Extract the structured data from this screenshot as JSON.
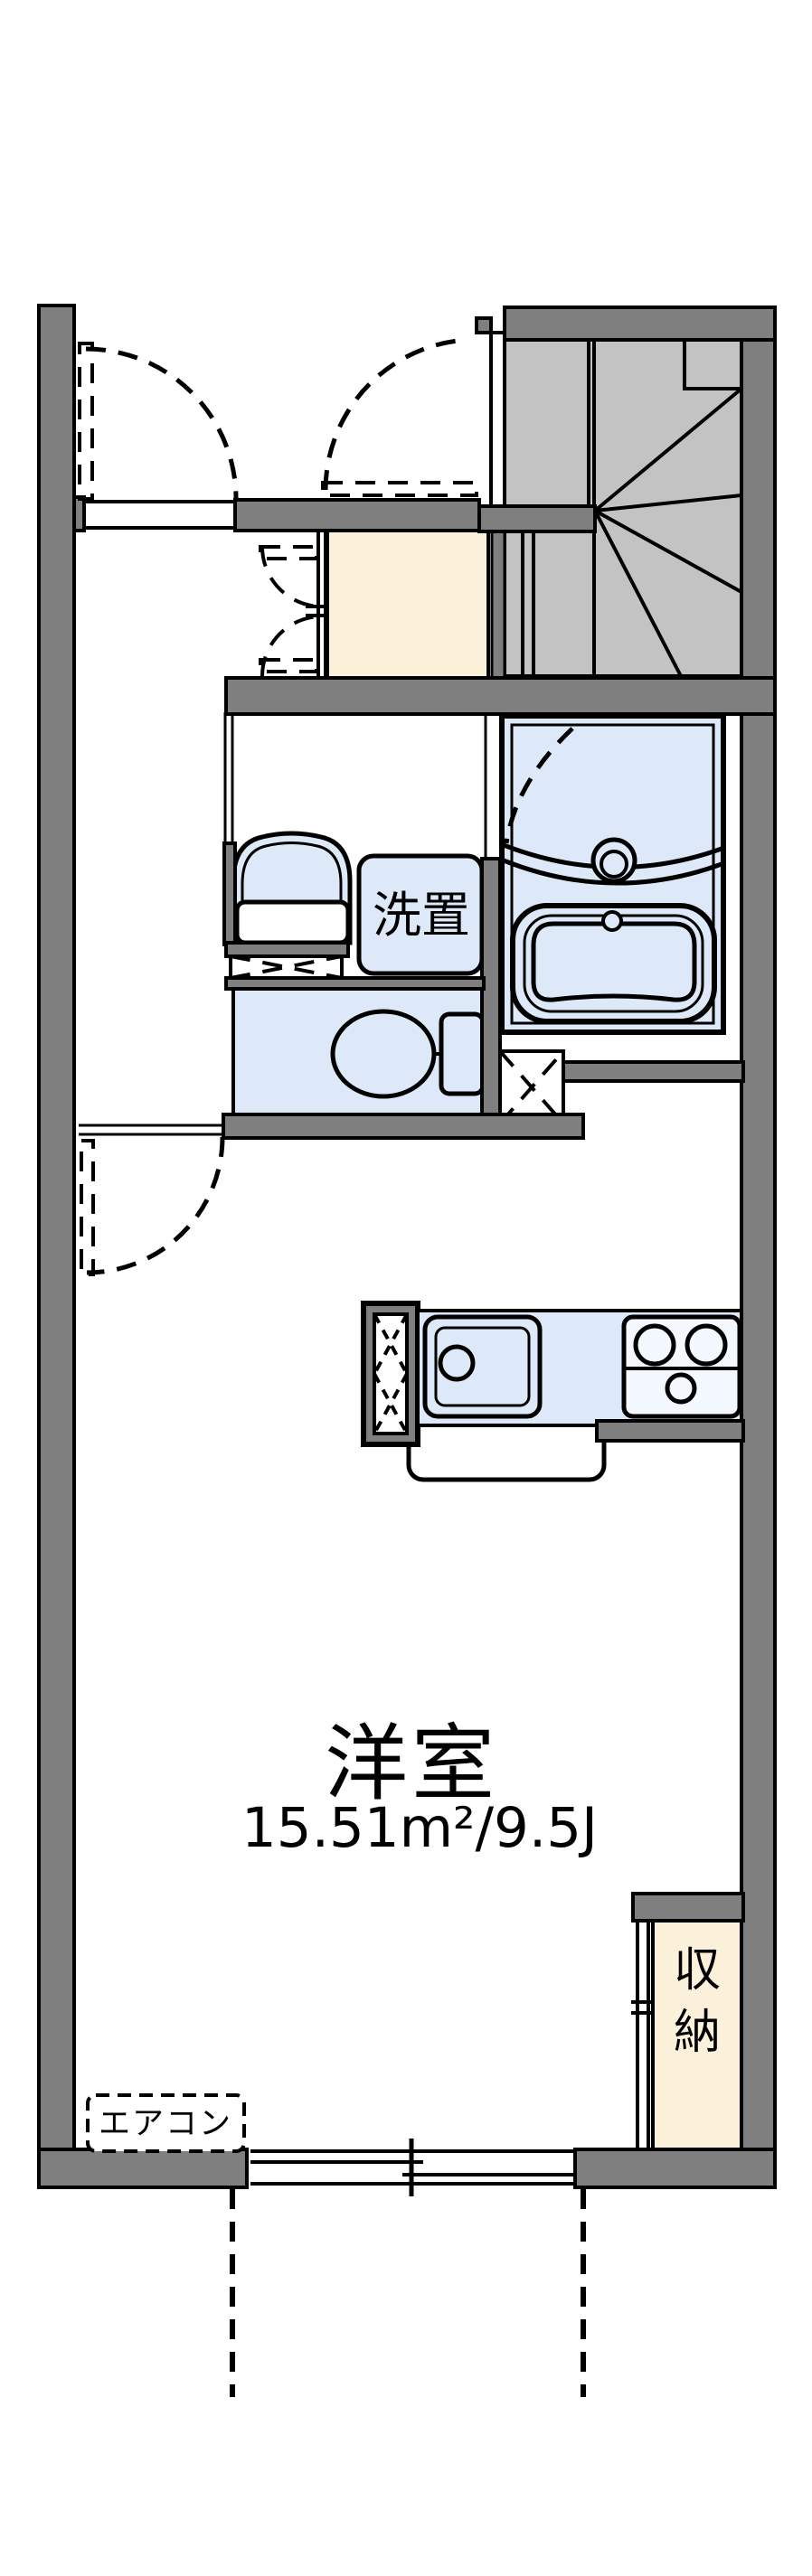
{
  "meta": {
    "type": "floor-plan",
    "room_count_text": "1K"
  },
  "colors": {
    "wall_gray": "#7F7F7F",
    "stair_gray": "#C3C3C3",
    "water_blue": "#DDE9F8",
    "cream": "#FBF0D9",
    "line_black": "#000000",
    "background": "#FFFFFF"
  },
  "labels": {
    "main_room_name": "洋室",
    "main_room_area": "15.51m²/9.5J",
    "washer_space": "洗置",
    "closet": "収納",
    "closet_chars": [
      "収",
      "納"
    ],
    "air_conditioner": "エアコン"
  }
}
